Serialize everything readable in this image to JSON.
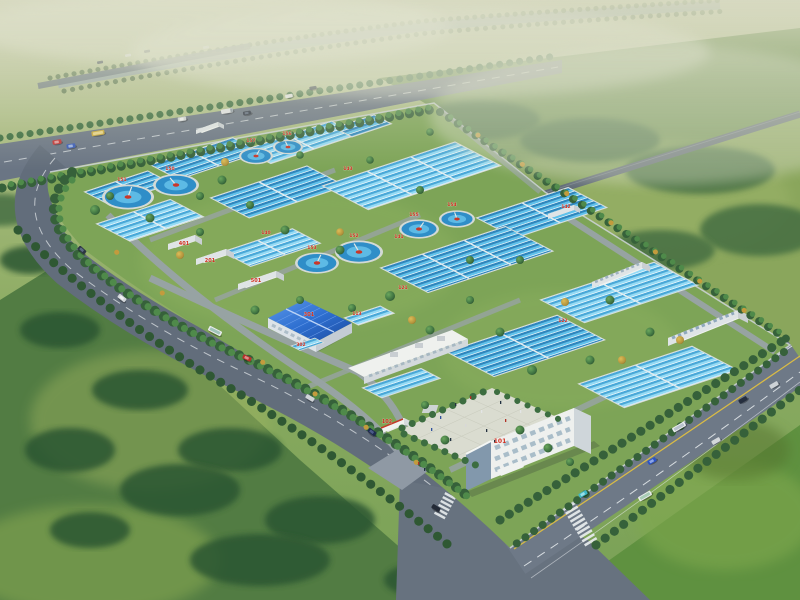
{
  "image": {
    "type": "architectural-aerial-rendering",
    "subject": "bird's-eye master-plan rendering of a large water / sewage treatment plant",
    "environment": "hazy horizon with tree-lined river, green fields and forest belts, perimeter avenues with traffic, crosswalk intersection at the south gate"
  },
  "palette": {
    "haze_top": "#d2d5ba",
    "field_light": "#a9b86e",
    "field_mid": "#7da455",
    "forest_dark": "#2e5832",
    "road_asphalt": "#6a7584",
    "road_distant": "#5f6a76",
    "marking_white": "#e9edf0",
    "marking_yellow": "#d9bb45",
    "basin_water_light": "#5fc2ec",
    "basin_water_dark": "#2e86bd",
    "basin_rim": "#d7dedc",
    "clarifier_water": "#2f8ec8",
    "clarifier_rim": "#d4dad6",
    "clarifier_center_red": "#c8372a",
    "roof_blue": "#2e6fd0",
    "building_white": "#f1f3f0",
    "plaza_paving": "#dadcd0",
    "label_red": "#cf2f1f"
  },
  "facility": {
    "counts": {
      "circular_clarifier_tanks": 8,
      "rectangular_basin_blocks": 15,
      "buildings": 12
    },
    "labels": {
      "buildings": [
        {
          "text": "101",
          "x": 500,
          "y": 443,
          "s": 6
        },
        {
          "text": "102",
          "x": 387,
          "y": 423,
          "s": 5
        },
        {
          "text": "201",
          "x": 210,
          "y": 262,
          "s": 5
        },
        {
          "text": "301",
          "x": 309,
          "y": 316,
          "s": 5
        },
        {
          "text": "302",
          "x": 301,
          "y": 346,
          "s": 4.5
        },
        {
          "text": "401",
          "x": 184,
          "y": 245,
          "s": 5
        },
        {
          "text": "501",
          "x": 256,
          "y": 282,
          "s": 5
        }
      ],
      "basins": [
        {
          "text": "140",
          "x": 266,
          "y": 234,
          "s": 4.5
        },
        {
          "text": "141",
          "x": 399,
          "y": 238,
          "s": 4.5
        },
        {
          "text": "142",
          "x": 566,
          "y": 208,
          "s": 4.5
        },
        {
          "text": "143",
          "x": 348,
          "y": 170,
          "s": 4.5
        },
        {
          "text": "121",
          "x": 403,
          "y": 289,
          "s": 4.5
        },
        {
          "text": "122",
          "x": 563,
          "y": 322,
          "s": 4.5
        },
        {
          "text": "113",
          "x": 357,
          "y": 315,
          "s": 4.5
        }
      ],
      "clarifiers": [
        {
          "text": "150",
          "x": 170,
          "y": 170,
          "s": 4.5
        },
        {
          "text": "151",
          "x": 122,
          "y": 181,
          "s": 4.5
        },
        {
          "text": "152",
          "x": 354,
          "y": 237,
          "s": 4.5
        },
        {
          "text": "153",
          "x": 312,
          "y": 249,
          "s": 4.5
        },
        {
          "text": "154",
          "x": 452,
          "y": 206,
          "s": 4.5
        },
        {
          "text": "155",
          "x": 414,
          "y": 216,
          "s": 4.5
        },
        {
          "text": "156",
          "x": 287,
          "y": 135,
          "s": 4.5
        },
        {
          "text": "157",
          "x": 251,
          "y": 142,
          "s": 4.5
        }
      ]
    }
  },
  "traffic": {
    "vehicle_count_visible": 28,
    "vehicle_types": [
      "sedans",
      "buses",
      "trucks"
    ],
    "crosswalks": 2
  }
}
